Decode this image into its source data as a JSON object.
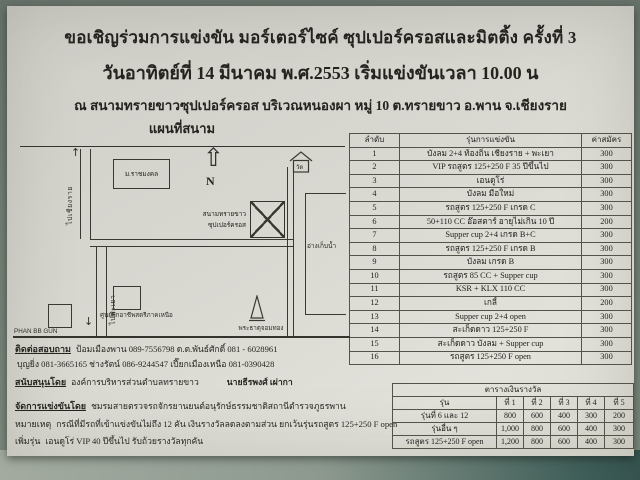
{
  "colors": {
    "paper": "#d8d7d0",
    "background": "#707d73",
    "ink": "#24231f",
    "table_surface_dark": "#3d5c57"
  },
  "header": {
    "title": "ขอเชิญร่วมการแข่งขัน มอร์เตอร์ไซค์ ซุปเปอร์ครอสและมิตติ้ง ครั้งที่ 3",
    "date_line": "วันอาทิตย์ที่ 14 มีนาคม พ.ศ.2553 เริ่มแข่งขันเวลา 10.00 น",
    "venue_line": "ณ สนามทรายขาวซุปเปอร์ครอส บริเวณหนองผา หมู่ 10 ต.ทรายขาว อ.พาน จ.เชียงราย"
  },
  "map": {
    "title": "แผนที่สนาม",
    "labels": {
      "to_chiangrai": "ไปเชียงราย",
      "to_phayao": "ไปพะเยา",
      "north": "N",
      "university": "ม.ราชมงคล",
      "temple": "วัด",
      "track_line1": "สนามทรายขาว",
      "track_line2": "ซุปเปอร์ครอส",
      "reservoir": "อ่างเก็บน้ำ",
      "bb_gun": "PHAN BB GUN",
      "training_center": "ศูนย์ฝึกอาชีพสตรีภาคเหนือ",
      "pagoda": "พระธาตุจอมทอง"
    }
  },
  "race_table": {
    "headers": {
      "no": "ลำดับ",
      "class": "รุ่นการแข่งขัน",
      "fee": "ค่าสมัคร"
    },
    "rows": [
      {
        "no": "1",
        "name": "บังลม 2+4 ท้องถิ่น เชียงราย + พะเยา",
        "fee": "300"
      },
      {
        "no": "2",
        "name": "VIP รถสูตร 125+250 F 35 ปีขึ้นไป",
        "fee": "300"
      },
      {
        "no": "3",
        "name": "เอนดูโร่",
        "fee": "300"
      },
      {
        "no": "4",
        "name": "บังลม มือใหม่",
        "fee": "300"
      },
      {
        "no": "5",
        "name": "รถสูตร 125+250 F เกรด C",
        "fee": "300"
      },
      {
        "no": "6",
        "name": "50+110 CC อ๊อสตาร์ อายุไม่เกิน 10 ปี",
        "fee": "200"
      },
      {
        "no": "7",
        "name": "Supper cup 2+4 เกรด B+C",
        "fee": "300"
      },
      {
        "no": "8",
        "name": "รถสูตร 125+250 F เกรด B",
        "fee": "300"
      },
      {
        "no": "9",
        "name": "บังลม เกรด B",
        "fee": "300"
      },
      {
        "no": "10",
        "name": "รถสูตร 85 CC + Supper cup",
        "fee": "300"
      },
      {
        "no": "11",
        "name": "KSR + KLX 110 CC",
        "fee": "300"
      },
      {
        "no": "12",
        "name": "เกลี้",
        "fee": "200"
      },
      {
        "no": "13",
        "name": "Supper cup 2+4 open",
        "fee": "300"
      },
      {
        "no": "14",
        "name": "สะเก็ดดาว 125+250 F",
        "fee": "300"
      },
      {
        "no": "15",
        "name": "สะเก็ดดาว บังลม + Supper cup",
        "fee": "300"
      },
      {
        "no": "16",
        "name": "รถสูตร 125+250 F open",
        "fee": "300"
      }
    ]
  },
  "prize_table": {
    "title": "ตารางเงินรางวัล",
    "headers": [
      "รุ่น",
      "ที่ 1",
      "ที่ 2",
      "ที่ 3",
      "ที่ 4",
      "ที่ 5"
    ],
    "rows": [
      {
        "class": "รุ่นที่ 6 และ 12",
        "p1": "800",
        "p2": "600",
        "p3": "400",
        "p4": "300",
        "p5": "200"
      },
      {
        "class": "รุ่นอื่น ๆ",
        "p1": "1,000",
        "p2": "800",
        "p3": "600",
        "p4": "400",
        "p5": "300"
      },
      {
        "class": "รถสูตร 125+250 F open",
        "p1": "1,200",
        "p2": "800",
        "p3": "600",
        "p4": "400",
        "p5": "300"
      }
    ]
  },
  "footer": {
    "contact_label": "ติดต่อสอบถาม",
    "contact_text": "ป้อมเมืองพาน 089-7556798  ด.ต.พันธ์ศักดิ์ 081 - 6028961",
    "contact_line2": "บุญยิ่ง 081-3665165  ช่างรัตน์ 086-9244547  เปี๊ยกเมืองเหนือ 081-0390428",
    "sponsor_label": "สนับสนุนโดย",
    "sponsor_org": "องค์การบริหารส่วนตำบลทรายขาว",
    "sponsor_name": "นายธีรพงศ์ เผ่ากา",
    "organizer_label": "จัดการแข่งขันโดย",
    "organizer_text": "ชมรมสายตรวจรถจักรยานยนต์อนุรักษ์ธรรมชาติสถานีตำรวจภูธรพาน",
    "note_label": "หมายเหตุ",
    "note_text": "กรณีที่มีรถที่เข้าแข่งขันไม่ถึง 12 คัน เงินรางวัลลดลงตามส่วน ยกเว้นรุ่นรถสูตร 125+250 F open",
    "extra_label": "เพิ่มรุ่น",
    "extra_text": "เอนดูโร่ VIP 40 ปีขึ้นไป รับถ้วยรางวัลทุกคัน"
  }
}
